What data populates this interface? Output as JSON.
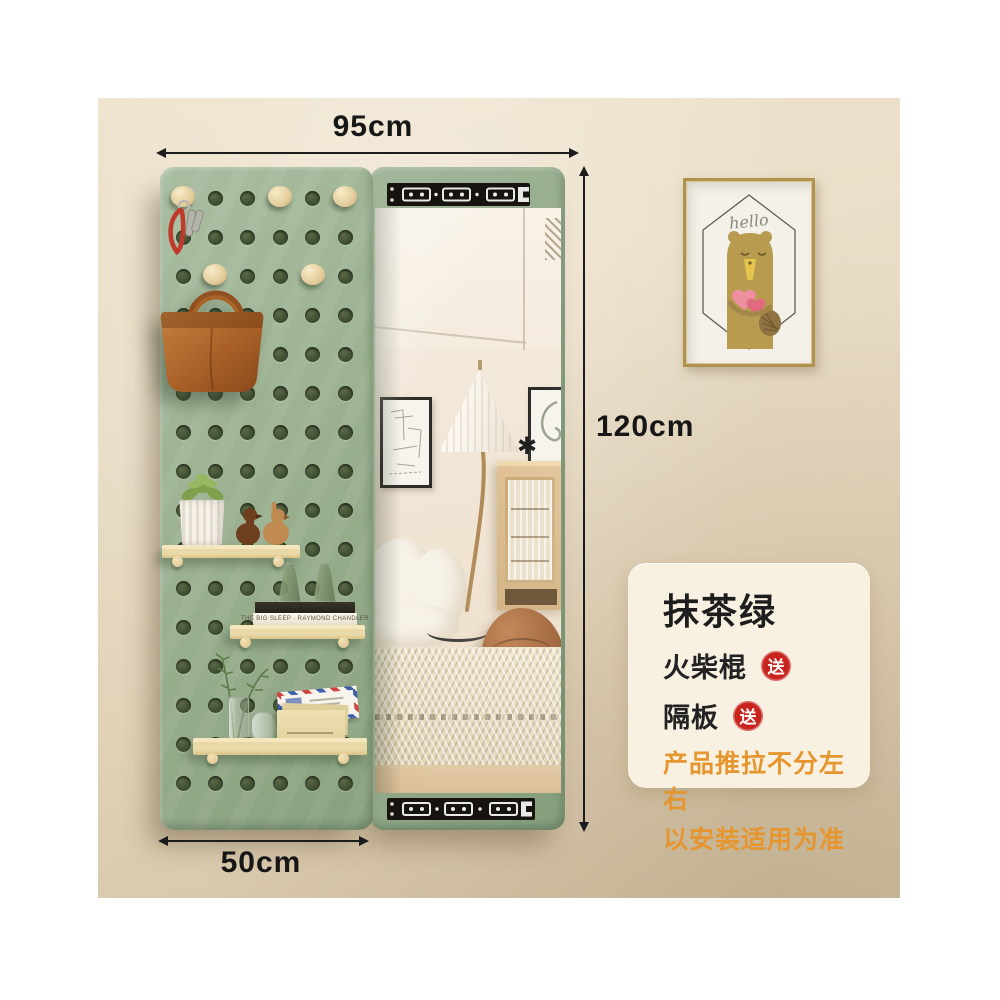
{
  "annotations": {
    "top_width": "95cm",
    "side_height": "120cm",
    "bottom_width": "50cm"
  },
  "info_card": {
    "title": "抹茶绿",
    "features": [
      {
        "label": "火柴棍",
        "badge": "送"
      },
      {
        "label": "隔板",
        "badge": "送"
      }
    ],
    "notes": [
      "产品推拉不分左右",
      "以安装适用为准"
    ]
  },
  "wall_frame": {
    "text": "hello"
  },
  "decor": {
    "book_spine": "THE BIG SLEEP · RAYMOND CHANDLER"
  },
  "pegboard": {
    "grid": {
      "cols": 6,
      "rows": 16,
      "x0": 85,
      "y0": 100,
      "dx": 32.4,
      "dy": 39,
      "hole": 15
    },
    "pegs": [
      [
        0,
        0
      ],
      [
        0,
        3
      ],
      [
        0,
        5
      ],
      [
        2,
        1
      ],
      [
        2,
        4
      ]
    ]
  },
  "colors": {
    "panel_green": "#9cb292",
    "shelf_wood": "#ead9a8",
    "rail_black": "#17140f",
    "badge_red": "#c8231d",
    "note_orange": "#e6962e",
    "bag_brown": "#b06c35",
    "frame_gold": "#b1934e",
    "wall_beige": "#e7dcc6"
  }
}
